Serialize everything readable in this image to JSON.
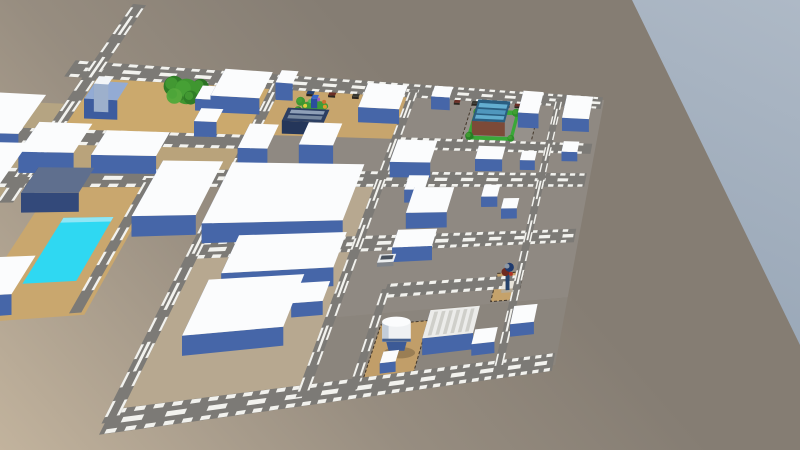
{
  "viewport": {
    "width": 800,
    "height": 450
  },
  "colors": {
    "ground_near": "#c2b39d",
    "ground_mid": "#978d80",
    "ground_far": "#857d73",
    "sky_top": "#aeb9c6",
    "sky_bottom": "#9aa8b8",
    "road": "#7c7a76",
    "road_marking": "#f2f2ee",
    "building_top": "#fbfcfd",
    "building_front": "#4666a8",
    "building_side": "#33508c",
    "fence": "#43372a",
    "tree_dark": "#2f7d27",
    "tree_light": "#4aa437",
    "pool_water": "#2fd8f2",
    "shadow": "#000000"
  },
  "scene": {
    "projection": {
      "quad_screen": {
        "p00": [
          95,
          70
        ],
        "p10": [
          600,
          103
        ],
        "p11": [
          552,
          358
        ],
        "p01": [
          -165,
          452
        ]
      },
      "u_max": 10,
      "v_max": 7.6,
      "kv": 2.172,
      "height_px_per_unit": 35
    },
    "sky": {
      "polygon": [
        [
          632,
          0
        ],
        [
          800,
          0
        ],
        [
          800,
          345
        ]
      ]
    },
    "lots": [
      {
        "name": "block-center-north",
        "u1": 2.85,
        "v1": -0.12,
        "u2": 5.5,
        "v2": 2.65,
        "color": "#8f8982"
      },
      {
        "name": "block-east",
        "u1": 5.5,
        "v1": -0.12,
        "u2": 10.1,
        "v2": 6.08,
        "color": "#8f8982"
      },
      {
        "name": "block-center-south",
        "u1": 2.85,
        "v1": 2.65,
        "u2": 5.55,
        "v2": 7.78,
        "color": "#b7a890"
      },
      {
        "name": "block-southeast",
        "u1": 5.5,
        "v1": 6.08,
        "u2": 10.1,
        "v2": 7.78,
        "color": "#8b857d"
      },
      {
        "name": "dirt-lot-northwest",
        "u1": 0.1,
        "v1": 0.06,
        "u2": 2.8,
        "v2": 1.62,
        "color": "#cba96d"
      },
      {
        "name": "dirt-lot-north-center",
        "u1": 2.95,
        "v1": 0.04,
        "u2": 5.45,
        "v2": 1.5,
        "color": "#c7a56d"
      },
      {
        "name": "dirt-strip-west",
        "u1": -0.3,
        "v1": 1.8,
        "u2": 2.85,
        "v2": 2.62,
        "color": "#b9a37b"
      },
      {
        "name": "dirt-outer-west",
        "u1": -2.0,
        "v1": 0.9,
        "u2": -0.1,
        "v2": 4.6,
        "color": "#b5a482"
      },
      {
        "name": "pool-deck",
        "u1": 0.45,
        "v1": 2.75,
        "u2": 1.85,
        "v2": 5.6,
        "color": "#c9a76e"
      },
      {
        "name": "water-tower-lot",
        "u1": 6.42,
        "v1": 6.35,
        "u2": 7.28,
        "v2": 7.62,
        "color": "#c19e69",
        "fence": true
      },
      {
        "name": "figure-lot",
        "u1": 8.42,
        "v1": 5.3,
        "u2": 8.98,
        "v2": 6.02,
        "color": "#c5a26b",
        "fence": true
      },
      {
        "name": "restaurant-parking",
        "u1": 6.85,
        "v1": 0.18,
        "u2": 8.45,
        "v2": 1.52,
        "color": "#96918b",
        "fence": true
      },
      {
        "name": "restaurant-lawn",
        "u1": 6.95,
        "v1": 0.45,
        "u2": 8.0,
        "v2": 1.45,
        "color": "#3aa838"
      },
      {
        "name": "restaurant-pad",
        "u1": 7.08,
        "v1": 0.6,
        "u2": 7.92,
        "v2": 1.32,
        "color": "#8d8984"
      }
    ],
    "roads": [
      {
        "name": "road-top",
        "u1": -0.35,
        "v1": 0,
        "u2": 10.05,
        "v2": 0,
        "w": 0.2,
        "center": true
      },
      {
        "name": "road-west-2",
        "u1": -0.6,
        "v1": 1.7,
        "u2": 2.9,
        "v2": 1.7,
        "w": 0.17,
        "center": false
      },
      {
        "name": "road-east-2",
        "u1": 5.5,
        "v1": 1.62,
        "u2": 10.0,
        "v2": 1.62,
        "w": 0.16,
        "center": false
      },
      {
        "name": "road-mid",
        "u1": -0.8,
        "v1": 2.65,
        "u2": 10.0,
        "v2": 2.65,
        "w": 0.2,
        "center": true
      },
      {
        "name": "road-lower-mid",
        "u1": 2.9,
        "v1": 4.35,
        "u2": 10.0,
        "v2": 4.35,
        "w": 0.18,
        "center": true
      },
      {
        "name": "road-bottom",
        "u1": 2.85,
        "v1": 7.7,
        "u2": 10.05,
        "v2": 7.7,
        "w": 0.2,
        "center": true
      },
      {
        "name": "road-se-connector",
        "u1": 6.3,
        "v1": 5.55,
        "u2": 8.95,
        "v2": 5.55,
        "w": 0.15,
        "center": false
      },
      {
        "name": "road-diag-nw",
        "u1": 0,
        "v1": -1.9,
        "u2": 0,
        "v2": 3.2,
        "w": 0.2,
        "center": true
      },
      {
        "name": "road-ns-1",
        "u1": 2.9,
        "v1": -0.05,
        "u2": 2.9,
        "v2": 7.72,
        "w": 0.18,
        "center": true
      },
      {
        "name": "road-ns-2",
        "u1": 5.5,
        "v1": -0.05,
        "u2": 5.5,
        "v2": 7.72,
        "w": 0.18,
        "center": true
      },
      {
        "name": "road-ns-tower",
        "u1": 6.3,
        "v1": 5.5,
        "u2": 6.3,
        "v2": 7.72,
        "w": 0.14,
        "center": false
      },
      {
        "name": "road-ns-east",
        "u1": 8.9,
        "v1": -0.05,
        "u2": 8.9,
        "v2": 7.72,
        "w": 0.17,
        "center": true
      },
      {
        "name": "road-pool-side",
        "u1": 1.72,
        "v1": 2.65,
        "u2": 1.72,
        "v2": 5.55,
        "w": 0.15,
        "center": false
      }
    ],
    "buildings": [
      {
        "name": "bldg-row1-big",
        "u1": 2.05,
        "v1": 0.18,
        "u2": 2.85,
        "v2": 0.95,
        "h": 0.5
      },
      {
        "name": "bldg-row1-small-a",
        "u1": 1.8,
        "v1": 0.55,
        "u2": 2.05,
        "v2": 0.92,
        "h": 0.35
      },
      {
        "name": "bldg-row1-small-b",
        "u1": 3.0,
        "v1": 0.15,
        "u2": 3.3,
        "v2": 0.52,
        "h": 0.55
      },
      {
        "name": "bldg-navy-store",
        "u1": 3.38,
        "v1": 1.08,
        "u2": 4.12,
        "v2": 1.45,
        "h": 0.4,
        "top": "#2c3f63",
        "front": "#24365a",
        "side": "#1b2a48",
        "deco": [
          {
            "axis": "v",
            "pos": 1.18,
            "a": 3.45,
            "b": 4.05,
            "w": 0.05,
            "color": "#8fa0b8"
          },
          {
            "axis": "v",
            "pos": 1.33,
            "a": 3.45,
            "b": 4.05,
            "w": 0.05,
            "color": "#76889f"
          }
        ]
      },
      {
        "name": "bldg-tall-west",
        "u1": 2.98,
        "v1": 1.9,
        "u2": 3.46,
        "v2": 2.55,
        "h": 0.78
      },
      {
        "name": "bldg-tall-east",
        "u1": 3.95,
        "v1": 1.8,
        "u2": 4.55,
        "v2": 2.42,
        "h": 0.78
      },
      {
        "name": "bldg-giant-north",
        "u1": 2.95,
        "v1": 2.72,
        "u2": 5.2,
        "v2": 4.2,
        "h": 0.55
      },
      {
        "name": "bldg-giant-mid",
        "u1": 3.6,
        "v1": 4.5,
        "u2": 5.35,
        "v2": 5.35,
        "h": 0.55
      },
      {
        "name": "bldg-giant-south",
        "u1": 3.45,
        "v1": 5.45,
        "u2": 4.9,
        "v2": 6.6,
        "h": 0.52
      },
      {
        "name": "bldg-annex",
        "u1": 4.85,
        "v1": 5.55,
        "u2": 5.35,
        "v2": 6.0,
        "h": 0.4
      },
      {
        "name": "bldg-north-slab",
        "u1": 4.65,
        "v1": 0.3,
        "u2": 5.45,
        "v2": 1.05,
        "h": 0.5
      },
      {
        "name": "bldg-north-small",
        "u1": 6.0,
        "v1": 0.2,
        "u2": 6.4,
        "v2": 0.55,
        "h": 0.45
      },
      {
        "name": "bldg-midcol-a",
        "u1": 5.65,
        "v1": 1.95,
        "u2": 6.45,
        "v2": 2.6,
        "h": 0.5
      },
      {
        "name": "bldg-midcol-b",
        "u1": 6.1,
        "v1": 2.9,
        "u2": 6.5,
        "v2": 3.3,
        "h": 0.42
      },
      {
        "name": "bldg-midcol-c",
        "u1": 6.3,
        "v1": 3.3,
        "u2": 7.1,
        "v2": 4.0,
        "h": 0.5
      },
      {
        "name": "bldg-midcol-d",
        "u1": 6.25,
        "v1": 4.4,
        "u2": 7.0,
        "v2": 4.85,
        "h": 0.45
      },
      {
        "name": "bldg-restaurant",
        "u1": 7.05,
        "v1": 0.6,
        "u2": 7.8,
        "v2": 1.3,
        "h": 0.5,
        "top": "#2a5e80",
        "front": "#7c4a38",
        "side": "#5e3527",
        "deco": [
          {
            "axis": "v",
            "pos": 0.78,
            "a": 7.1,
            "b": 7.75,
            "w": 0.07,
            "color": "#63aed0"
          },
          {
            "axis": "v",
            "pos": 0.98,
            "a": 7.1,
            "b": 7.75,
            "w": 0.07,
            "color": "#4f97bd"
          },
          {
            "axis": "v",
            "pos": 1.16,
            "a": 7.1,
            "b": 7.75,
            "w": 0.06,
            "color": "#63aed0"
          }
        ]
      },
      {
        "name": "bldg-l-white",
        "u1": 8.05,
        "v1": 0.25,
        "u2": 8.55,
        "v2": 1.0,
        "h": 0.55
      },
      {
        "name": "bldg-ne-corner",
        "u1": 9.15,
        "v1": 0.25,
        "u2": 9.85,
        "v2": 1.05,
        "h": 0.5
      },
      {
        "name": "bldg-ne-small",
        "u1": 9.3,
        "v1": 1.7,
        "u2": 9.7,
        "v2": 2.05,
        "h": 0.35
      },
      {
        "name": "bldg-rc-a",
        "u1": 7.35,
        "v1": 2.0,
        "u2": 7.95,
        "v2": 2.4,
        "h": 0.42
      },
      {
        "name": "bldg-rc-b",
        "u1": 8.35,
        "v1": 2.05,
        "u2": 8.7,
        "v2": 2.35,
        "h": 0.35
      },
      {
        "name": "bldg-rc-c",
        "u1": 7.7,
        "v1": 3.1,
        "u2": 8.05,
        "v2": 3.45,
        "h": 0.35
      },
      {
        "name": "bldg-rc-d",
        "u1": 8.2,
        "v1": 3.5,
        "u2": 8.55,
        "v2": 3.8,
        "h": 0.35
      },
      {
        "name": "bldg-warehouse",
        "u1": 7.35,
        "v1": 6.5,
        "u2": 8.3,
        "v2": 7.15,
        "h": 0.5,
        "top": "#ececea",
        "deco": [
          {
            "axis": "u",
            "pos": 7.47,
            "a": 6.55,
            "b": 7.1,
            "w": 0.035,
            "color": "#cfcfca"
          },
          {
            "axis": "u",
            "pos": 7.61,
            "a": 6.55,
            "b": 7.1,
            "w": 0.035,
            "color": "#cfcfca"
          },
          {
            "axis": "u",
            "pos": 7.75,
            "a": 6.55,
            "b": 7.1,
            "w": 0.035,
            "color": "#cfcfca"
          },
          {
            "axis": "u",
            "pos": 7.89,
            "a": 6.55,
            "b": 7.1,
            "w": 0.035,
            "color": "#cfcfca"
          },
          {
            "axis": "u",
            "pos": 8.03,
            "a": 6.55,
            "b": 7.1,
            "w": 0.035,
            "color": "#cfcfca"
          },
          {
            "axis": "u",
            "pos": 8.17,
            "a": 6.55,
            "b": 7.1,
            "w": 0.035,
            "color": "#cfcfca"
          }
        ]
      },
      {
        "name": "bldg-se-a",
        "u1": 9.0,
        "v1": 6.5,
        "u2": 9.5,
        "v2": 6.95,
        "h": 0.4
      },
      {
        "name": "bldg-se-b",
        "u1": 8.3,
        "v1": 6.95,
        "u2": 8.75,
        "v2": 7.3,
        "h": 0.35
      },
      {
        "name": "bldg-tower-shed",
        "u1": 6.68,
        "v1": 7.2,
        "u2": 6.95,
        "v2": 7.45,
        "h": 0.3
      },
      {
        "name": "bldg-leftcol-a",
        "u1": 0.85,
        "v1": 1.95,
        "u2": 1.75,
        "v2": 2.55,
        "h": 0.5
      },
      {
        "name": "bldg-leftcol-b",
        "u1": -0.08,
        "v1": 1.85,
        "u2": 0.62,
        "v2": 2.55,
        "h": 0.55
      },
      {
        "name": "bldg-pool-east",
        "u1": 1.9,
        "v1": 2.7,
        "u2": 2.8,
        "v2": 4.0,
        "h": 0.55
      },
      {
        "name": "bldg-pool-south",
        "u1": 0.1,
        "v1": 4.75,
        "u2": 0.95,
        "v2": 5.5,
        "h": 0.5
      },
      {
        "name": "bldg-pool-north-dark",
        "u1": 0.28,
        "v1": 2.85,
        "u2": 1.0,
        "v2": 3.42,
        "h": 0.5,
        "top": "#5f6f8e",
        "front": "#33497a",
        "side": "#263a66"
      },
      {
        "name": "bldg-outer-nw",
        "u1": -1.45,
        "v1": 1.15,
        "u2": -0.25,
        "v2": 2.1,
        "h": 0.5
      },
      {
        "name": "bldg-outer-w",
        "u1": -1.2,
        "v1": 2.3,
        "u2": -0.05,
        "v2": 3.6,
        "h": 0.5
      },
      {
        "name": "bldg-small-209",
        "u1": 2.0,
        "v1": 1.25,
        "u2": 2.35,
        "v2": 1.6,
        "h": 0.45
      },
      {
        "name": "water-tank-base",
        "u1": 0.29,
        "v1": 0.78,
        "u2": 0.75,
        "v2": 1.24,
        "h": 0.55,
        "top": "#93abd4",
        "front": "#3d5c9e",
        "side": "#2e4a86"
      },
      {
        "name": "water-tank-cap",
        "u1": 0.36,
        "v1": 0.86,
        "u2": 0.56,
        "v2": 1.06,
        "h": 0.78,
        "top": "#f2f5f8",
        "front": "#9db0cc",
        "side": "#8396b6",
        "sort_v": 1.3
      }
    ],
    "trees": [
      {
        "u": 1.27,
        "v": 0.3,
        "r": 0.16,
        "color": "#2f7d27"
      },
      {
        "u": 1.5,
        "v": 0.42,
        "r": 0.2,
        "color": "#3f9630"
      },
      {
        "u": 1.68,
        "v": 0.28,
        "r": 0.13,
        "color": "#2b7224"
      },
      {
        "u": 1.36,
        "v": 0.56,
        "r": 0.12,
        "color": "#55a93c"
      },
      {
        "u": 1.62,
        "v": 0.58,
        "r": 0.11,
        "color": "#2f7d27"
      },
      {
        "u": 7.02,
        "v": 0.56,
        "r": 0.09,
        "color": "#2e8f2a"
      },
      {
        "u": 7.92,
        "v": 0.52,
        "r": 0.1,
        "color": "#2e8f2a"
      },
      {
        "u": 7.0,
        "v": 1.33,
        "r": 0.09,
        "color": "#277f24"
      },
      {
        "u": 7.95,
        "v": 1.36,
        "r": 0.08,
        "color": "#2e8f2a"
      },
      {
        "u": 3.44,
        "v": 0.52,
        "r": 0.08,
        "color": "#3f9630"
      },
      {
        "u": 3.47,
        "v": 0.78,
        "r": 0.07,
        "color": "#2f7d27"
      }
    ],
    "playground": {
      "name": "playground",
      "u": 3.735,
      "v": 0.64,
      "r": 0.24,
      "base_color": "#3f9c38",
      "dot_colors": [
        "#e09a2c",
        "#d05a2c",
        "#3a66c8",
        "#d84040",
        "#e0cf3e",
        "#58b858",
        "#9a5fc0",
        "#cc7030"
      ],
      "center_box": {
        "u1": 3.68,
        "v1": 0.58,
        "u2": 3.79,
        "v2": 0.7,
        "h": 0.3,
        "top": "#3a66c8",
        "front": "#2b4d9e",
        "side": "#1f3a7e"
      }
    },
    "pool": {
      "name": "swimming-pool",
      "u1": 0.85,
      "v1": 3.55,
      "u2": 1.5,
      "v2": 4.9,
      "water": "#2fd8f2",
      "rim": "#8fe6f5"
    },
    "water_tower": {
      "name": "water-tower",
      "u": 6.85,
      "v": 6.98,
      "r": 0.25,
      "h": 0.85,
      "body": "#eff1f3",
      "shade": "#c3cdd9",
      "dome": "#fbfcfd",
      "band": "#46618f",
      "legs": "#3c5a96"
    },
    "figure": {
      "name": "utility-figure",
      "base": {
        "u1": 8.6,
        "v1": 5.62,
        "u2": 8.84,
        "v2": 5.82,
        "h": 0.12,
        "top": "#e9e5db",
        "front": "#b5ab98",
        "side": "#a3987f"
      },
      "pole": {
        "u1": 8.68,
        "v1": 5.66,
        "u2": 8.76,
        "v2": 5.76,
        "h": 0.55,
        "top": "#30507c",
        "front": "#27436b",
        "side": "#1d3355"
      },
      "blobs": [
        {
          "u": 8.66,
          "v": 5.68,
          "h": 0.5,
          "r": 4,
          "color": "#6e2a1f"
        },
        {
          "u": 8.74,
          "v": 5.66,
          "h": 0.62,
          "r": 4.5,
          "color": "#1e3a6e"
        },
        {
          "u": 8.7,
          "v": 5.72,
          "h": 0.74,
          "r": 2.5,
          "color": "#8b97a6"
        },
        {
          "u": 8.78,
          "v": 5.7,
          "h": 0.45,
          "r": 2,
          "color": "#b03326"
        }
      ]
    },
    "car": {
      "name": "car",
      "u1": 6.0,
      "v1": 4.75,
      "u2": 6.3,
      "v2": 4.95,
      "h": 0.13,
      "top": "#eceff1",
      "front": "#7d8289",
      "side": "#5f646b",
      "deco": [
        {
          "axis": "v",
          "pos": 4.83,
          "a": 6.04,
          "b": 6.26,
          "w": 0.05,
          "color": "#49525e"
        }
      ]
    },
    "street_props": {
      "name": "street-clutter",
      "v": 0.27,
      "size_u": 0.13,
      "size_v": 0.09,
      "h": 0.07,
      "u_positions": [
        3.1,
        3.5,
        3.9,
        4.35,
        4.75,
        5.15,
        6.0,
        6.45,
        6.85,
        7.1,
        7.35,
        7.6,
        7.85,
        8.1
      ],
      "colors": [
        "#4a3b31",
        "#27406e",
        "#6b2f26",
        "#3a3a34",
        "#58452f"
      ]
    }
  }
}
